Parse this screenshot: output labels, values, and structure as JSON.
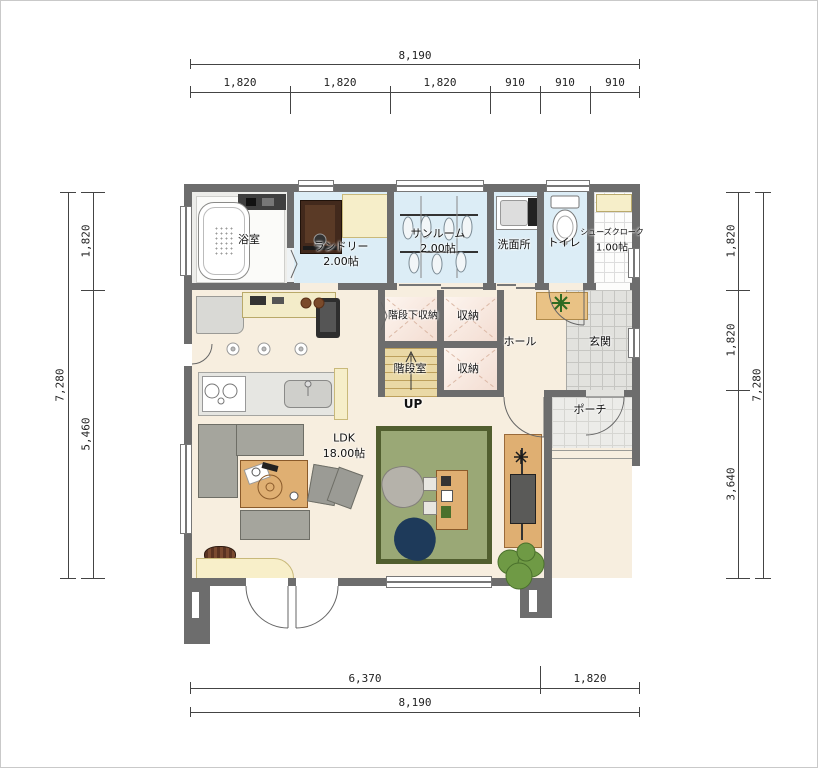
{
  "dimensions": {
    "top": {
      "total": "8,190",
      "segments": [
        "1,820",
        "1,820",
        "1,820",
        "910",
        "910",
        "910"
      ]
    },
    "bottom": {
      "total": "8,190",
      "segments": [
        "6,370",
        "1,820"
      ]
    },
    "left": {
      "total": "7,280",
      "segments": [
        "1,820",
        "5,460"
      ]
    },
    "right": {
      "total": "7,280",
      "segments": [
        "1,820",
        "1,820",
        "3,640"
      ]
    }
  },
  "rooms": {
    "bathroom": {
      "label": "浴室"
    },
    "laundry": {
      "label": "ランドリー",
      "size": "2.00帖"
    },
    "sunroom": {
      "label": "サンルーム",
      "size": "2.00帖"
    },
    "washroom": {
      "label": "洗面所"
    },
    "toilet": {
      "label": "トイレ"
    },
    "shoe_closet": {
      "label": "シューズクローク",
      "size": "1.00帖"
    },
    "understair_storage": {
      "label": "階段下収納"
    },
    "storage_upper": {
      "label": "収納"
    },
    "storage_lower": {
      "label": "収納"
    },
    "stair_room": {
      "label": "階段室",
      "direction": "UP"
    },
    "hall": {
      "label": "ホール"
    },
    "entrance": {
      "label": "玄関"
    },
    "porch": {
      "label": "ポーチ"
    },
    "ldk": {
      "label": "LDK",
      "size": "18.00帖"
    }
  },
  "colors": {
    "wall": "#6d6d6d",
    "floor_main": "#f7eedf",
    "floor_wet": "#dcedf6",
    "floor_stairs": "#ead9a6",
    "floor_storage": "#f6e3d8",
    "tile_entrance": "#e2e2de",
    "tile_porch": "#ecece9",
    "wood": "#dfaf72",
    "counter": "#f6eec9",
    "sofa": "#a5a59d",
    "rug": "#9aa876",
    "rug_border": "#515e2f",
    "navy": "#1e3a5a",
    "plant": "#6f9a45",
    "washer": "#42291c"
  }
}
